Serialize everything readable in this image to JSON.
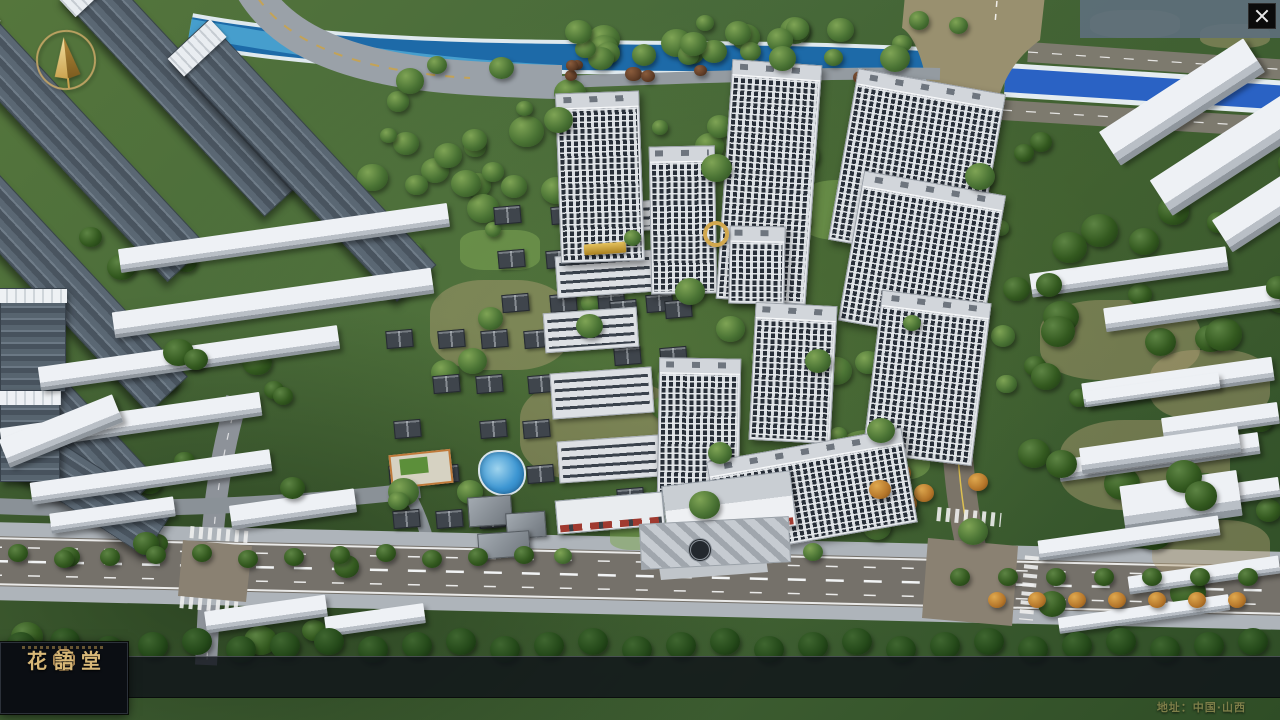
{
  "window": {
    "close_icon": "x"
  },
  "nav": {
    "items": [
      {
        "num": "o1",
        "zh": "品牌·介绍",
        "en": "BRAND SUPPORT"
      },
      {
        "num": "o2",
        "zh": "区位·价值",
        "en": "LOCATION VALUE"
      },
      {
        "num": "o3",
        "zh": "项目·概况",
        "en": "PROJECT SURVEY"
      },
      {
        "num": "o4",
        "zh": "建筑·鉴赏",
        "en": "APPRECIATION"
      },
      {
        "num": "o5",
        "zh": "园林·景观",
        "en": "GARDEN STREET"
      },
      {
        "num": "o6",
        "zh": "精装·体验",
        "en": "EXPERIENCE"
      },
      {
        "num": "o7",
        "zh": "户型·分布",
        "en": "SHOW ROOM"
      },
      {
        "num": "o8",
        "zh": "一房·一景",
        "en": "COMMUNITY"
      }
    ]
  },
  "logo": {
    "title": "花語堂"
  },
  "footer": {
    "address": "地址：中国·山西"
  },
  "colors": {
    "gold": "#c9a566",
    "nav_bg": "rgba(16,20,26,0.82)",
    "river": "#1d6aa8",
    "canal": "#2a62c4",
    "road": "#75716a",
    "ground_green": "#47693a"
  }
}
